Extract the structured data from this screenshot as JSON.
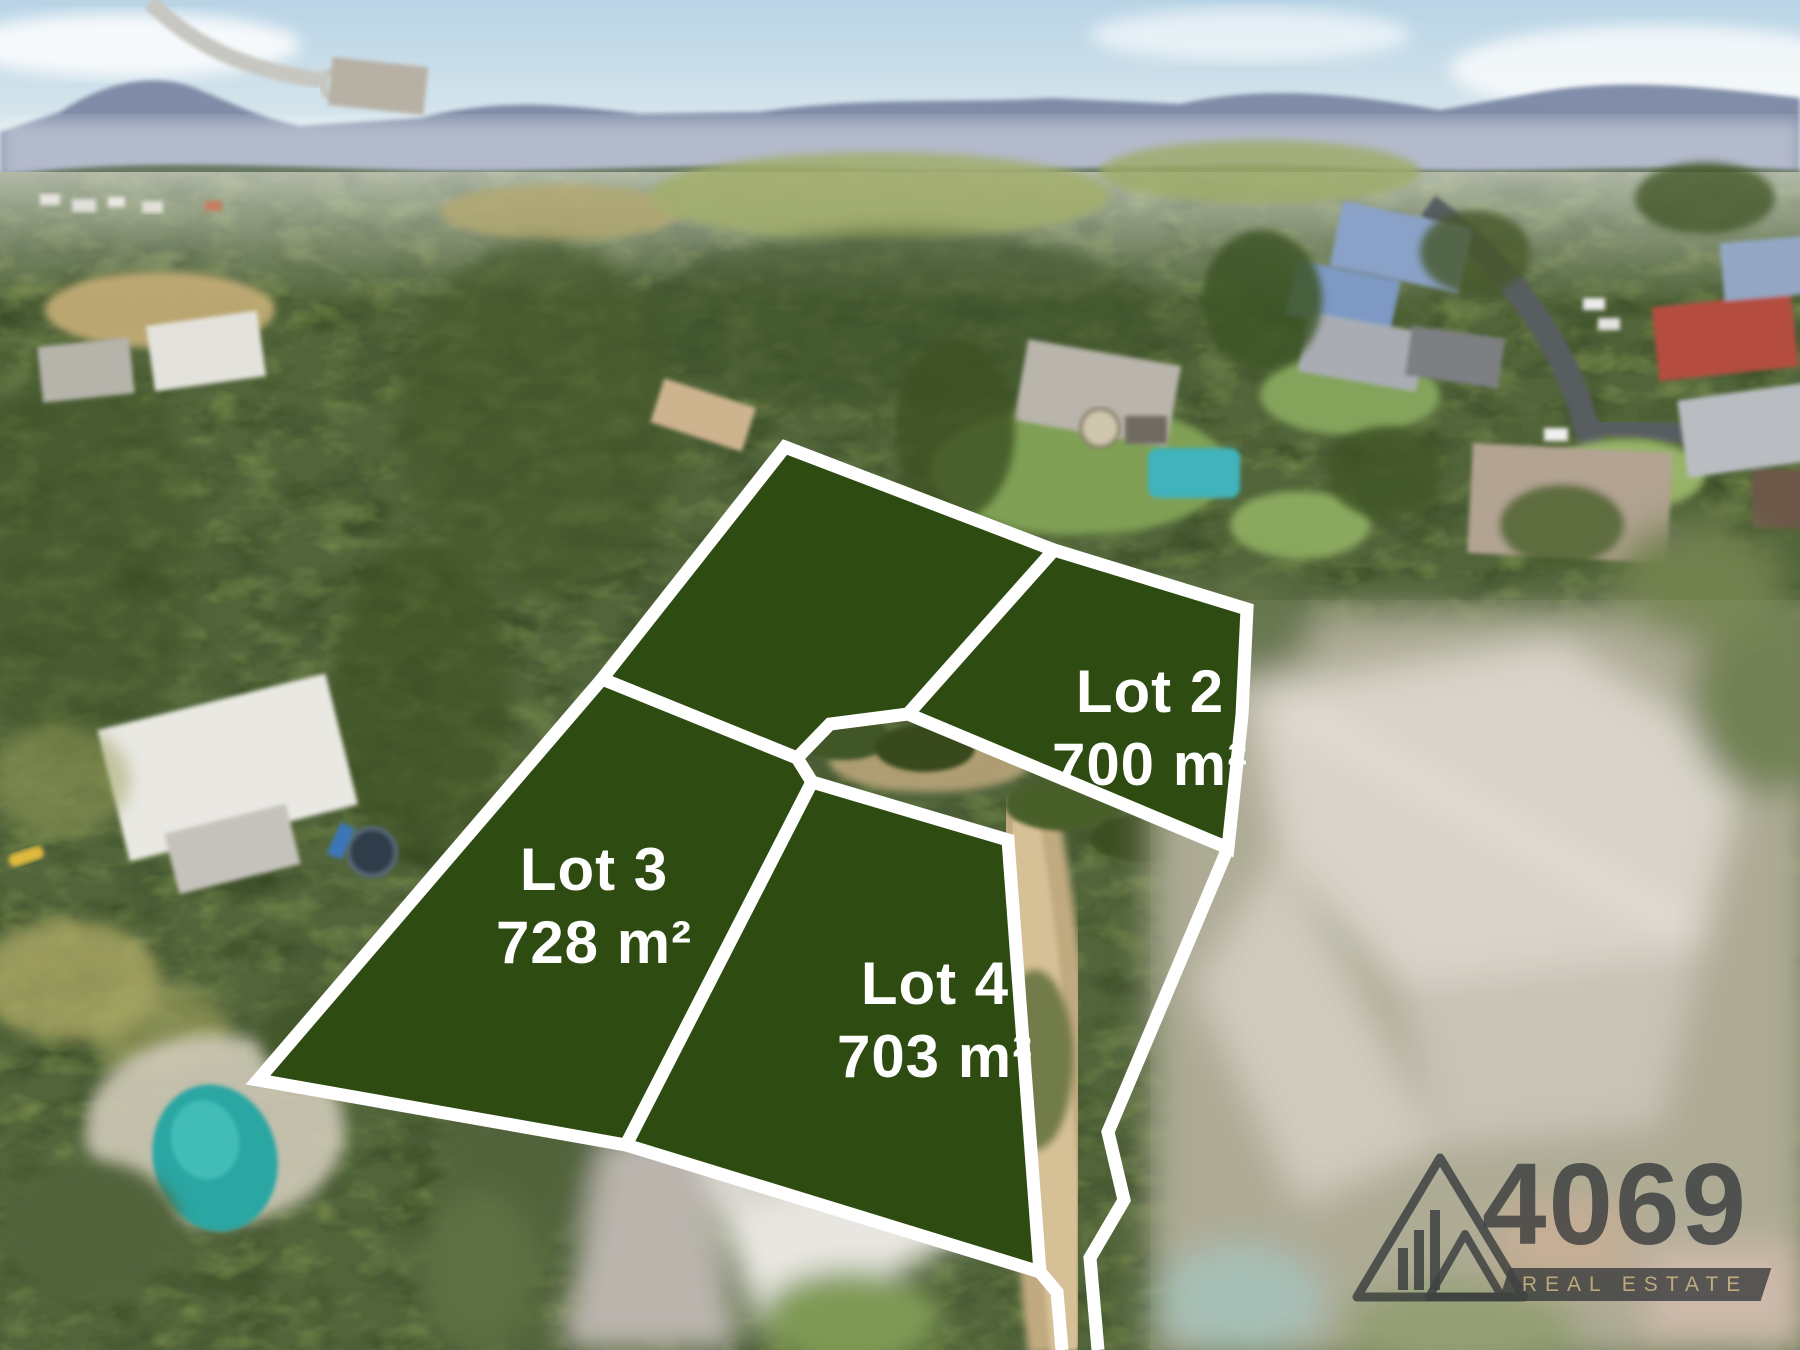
{
  "page": {
    "type": "aerial-subdivision-photo",
    "width_px": 1800,
    "height_px": 1350
  },
  "lots": {
    "lot2": {
      "name": "Lot 2",
      "area": "700 m²"
    },
    "lot3": {
      "name": "Lot 3",
      "area": "728 m²"
    },
    "lot4": {
      "name": "Lot 4",
      "area": "703 m²"
    }
  },
  "watermark": {
    "brand_number": "4069",
    "brand_tagline": "REAL ESTATE"
  },
  "colors": {
    "lot_fill": "#2e4b11",
    "lot_border": "#ffffff",
    "lot_text": "#ffffff",
    "logo_ink": "#2a2f32",
    "logo_gold": "#bda875"
  }
}
